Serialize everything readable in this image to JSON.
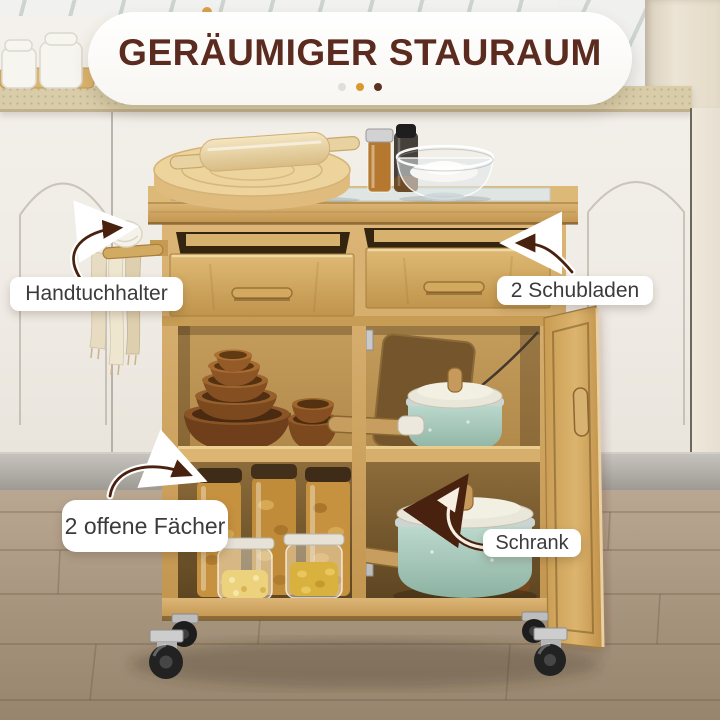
{
  "banner": {
    "title": "GERÄUMIGER STAURAUM",
    "title_color": "#5a2b1e",
    "dots": [
      {
        "name": "gray-dot",
        "color": "#e0ddda"
      },
      {
        "name": "orange-dot",
        "color": "#d9992f"
      },
      {
        "name": "brown-dot",
        "color": "#5d3222"
      }
    ],
    "top_dot_color": "#d9a04a"
  },
  "callouts": {
    "towel_holder": "Handtuchhalter",
    "drawers": "2 Schubladen",
    "open_shelves": "2 offene Fächer",
    "cabinet": "Schrank"
  },
  "colors": {
    "bamboo": "#cfa45e",
    "bamboo_interior_dark": "#7a5c30",
    "teal_cookware": "#a7cabe",
    "label_text": "#3b3b3b",
    "arrow_brown": "#48220f",
    "countertop": "#d9cda9",
    "floor": "#a5937c"
  }
}
